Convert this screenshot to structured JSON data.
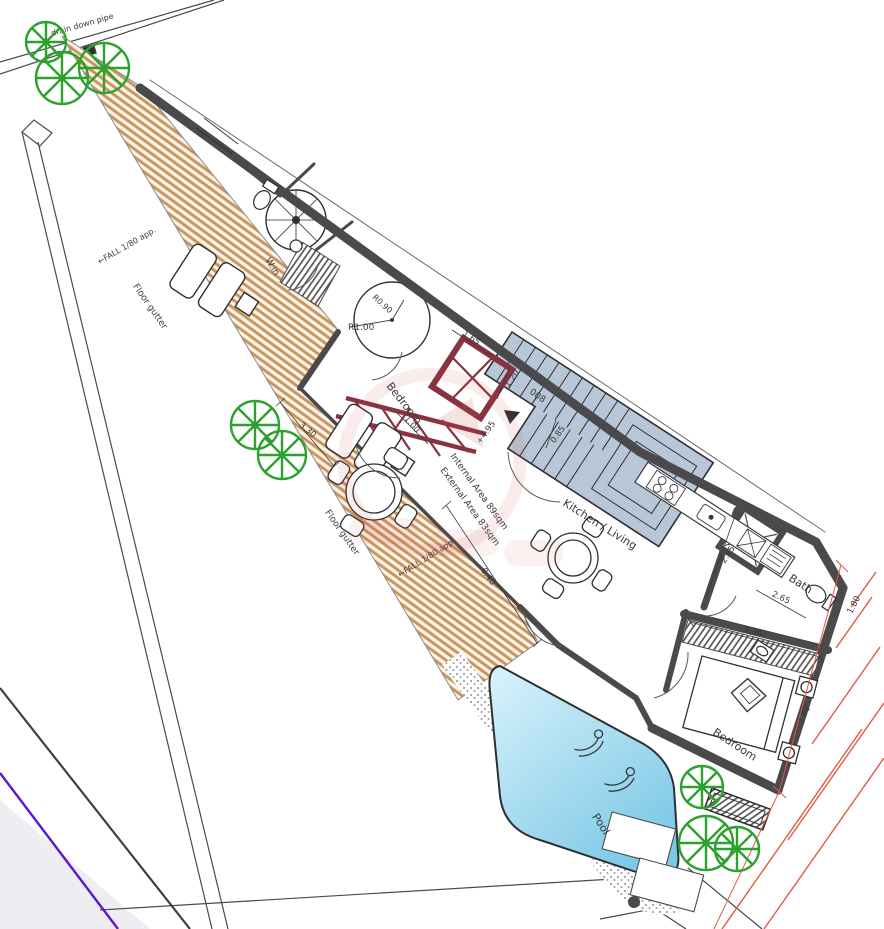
{
  "plan": {
    "rooms": {
      "bedroom_upper": "Bedroom",
      "bedroom_lower": "Bedroom",
      "kitchen_living": "Kitchen / Living",
      "bath": "Bath",
      "pool": "Pool",
      "walk_in": "W.in",
      "room_number": "008"
    },
    "annotations": {
      "drain_down_pipe": "drain down pipe",
      "floor_gutter_upper": "Floor gutter",
      "floor_gutter_lower": "Floor gutter",
      "fall_upper": "←FALL 1/80 app.",
      "fall_lower": "←FALL 1/80 app.",
      "internal_area": "Internal Area 89sqm",
      "external_area": "External Area 83sqm",
      "level_marker": "+4.95"
    },
    "dimensions": {
      "radius_large": "R1.00",
      "radius_small": "R0.90",
      "door_width": "1.00",
      "landing_width": "1.20",
      "stair_width_top": "1.65",
      "stair_step": "0.85",
      "bath_width": "2.45",
      "bath_length": "2.65",
      "bedroom_width": "3.30",
      "terrace_width": "3.30",
      "bedroom_length": "3.90",
      "terrace_length": "8.40",
      "setback": "1.80"
    },
    "colors": {
      "wall_dark": "#4a4a4c",
      "terrace_hatch": "#c8935c",
      "stair_fill": "#b8c7d7",
      "red_overlay": "#8a3340",
      "tree_green": "#2da12d",
      "pool_light": "#d6f1fb",
      "pool_dark": "#7cc8e6",
      "boundary_red": "#e05a45",
      "utility_purple": "#5a17d0",
      "watermark_red": "#d04848",
      "stipple_gray": "#8f8f8f"
    }
  }
}
